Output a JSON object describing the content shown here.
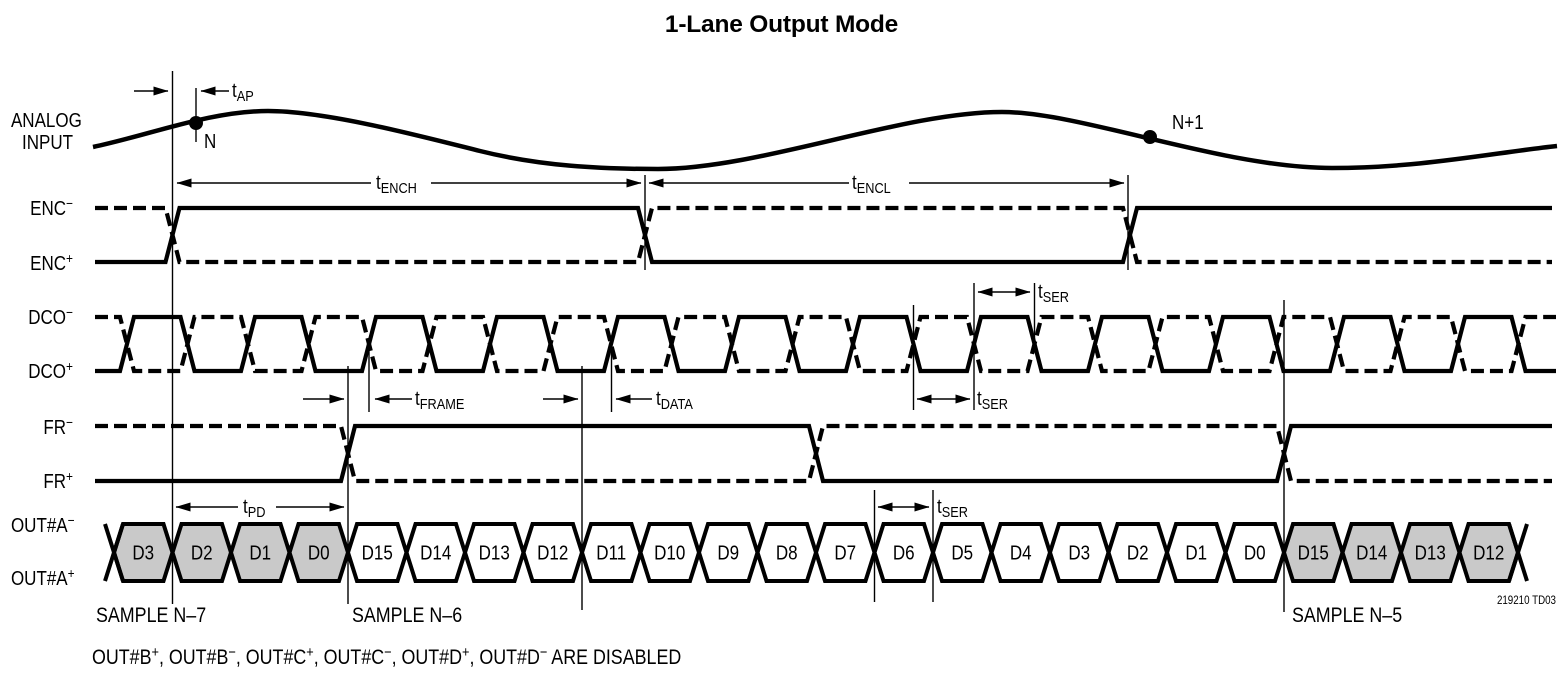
{
  "title": "1-Lane Output Mode",
  "analog_input_label": {
    "line1": "ANALOG",
    "line2": "INPUT"
  },
  "signals": [
    {
      "base": "ENC",
      "sign": "−"
    },
    {
      "base": "ENC",
      "sign": "+"
    },
    {
      "base": "DCO",
      "sign": "−"
    },
    {
      "base": "DCO",
      "sign": "+"
    },
    {
      "base": "FR",
      "sign": "−"
    },
    {
      "base": "FR",
      "sign": "+"
    },
    {
      "base": "OUT#A",
      "sign": "−"
    },
    {
      "base": "OUT#A",
      "sign": "+"
    }
  ],
  "sample_points": {
    "n": "N",
    "n_plus_1": "N+1"
  },
  "annotations": {
    "tap": {
      "t": "t",
      "sub": "AP"
    },
    "tench": {
      "t": "t",
      "sub": "ENCH"
    },
    "tencl": {
      "t": "t",
      "sub": "ENCL"
    },
    "tframe": {
      "t": "t",
      "sub": "FRAME"
    },
    "tdata": {
      "t": "t",
      "sub": "DATA"
    },
    "tser": {
      "t": "t",
      "sub": "SER"
    },
    "tpd": {
      "t": "t",
      "sub": "PD"
    }
  },
  "bus": {
    "cells": [
      {
        "label": "D3",
        "shaded": true
      },
      {
        "label": "D2",
        "shaded": true
      },
      {
        "label": "D1",
        "shaded": true
      },
      {
        "label": "D0",
        "shaded": true
      },
      {
        "label": "D15",
        "shaded": false
      },
      {
        "label": "D14",
        "shaded": false
      },
      {
        "label": "D13",
        "shaded": false
      },
      {
        "label": "D12",
        "shaded": false
      },
      {
        "label": "D11",
        "shaded": false
      },
      {
        "label": "D10",
        "shaded": false
      },
      {
        "label": "D9",
        "shaded": false
      },
      {
        "label": "D8",
        "shaded": false
      },
      {
        "label": "D7",
        "shaded": false
      },
      {
        "label": "D6",
        "shaded": false
      },
      {
        "label": "D5",
        "shaded": false
      },
      {
        "label": "D4",
        "shaded": false
      },
      {
        "label": "D3",
        "shaded": false
      },
      {
        "label": "D2",
        "shaded": false
      },
      {
        "label": "D1",
        "shaded": false
      },
      {
        "label": "D0",
        "shaded": false
      },
      {
        "label": "D15",
        "shaded": true
      },
      {
        "label": "D14",
        "shaded": true
      },
      {
        "label": "D13",
        "shaded": true
      },
      {
        "label": "D12",
        "shaded": true
      }
    ]
  },
  "samples": [
    "SAMPLE N–7",
    "SAMPLE N–6",
    "SAMPLE N–5"
  ],
  "note_segments": [
    {
      "text": "OUT#B"
    },
    {
      "sup": "+"
    },
    {
      "text": ", OUT#B"
    },
    {
      "sup": "−"
    },
    {
      "text": ", OUT#C"
    },
    {
      "sup": "+"
    },
    {
      "text": ", OUT#C"
    },
    {
      "sup": "−"
    },
    {
      "text": ", OUT#D"
    },
    {
      "sup": "+"
    },
    {
      "text": ", OUT#D"
    },
    {
      "sup": "−"
    },
    {
      "text": " ARE DISABLED"
    }
  ],
  "footer_code": "219210 TD03",
  "colors": {
    "ink": "#000000",
    "background": "#ffffff",
    "shaded_cell": "#c9c9c9"
  }
}
